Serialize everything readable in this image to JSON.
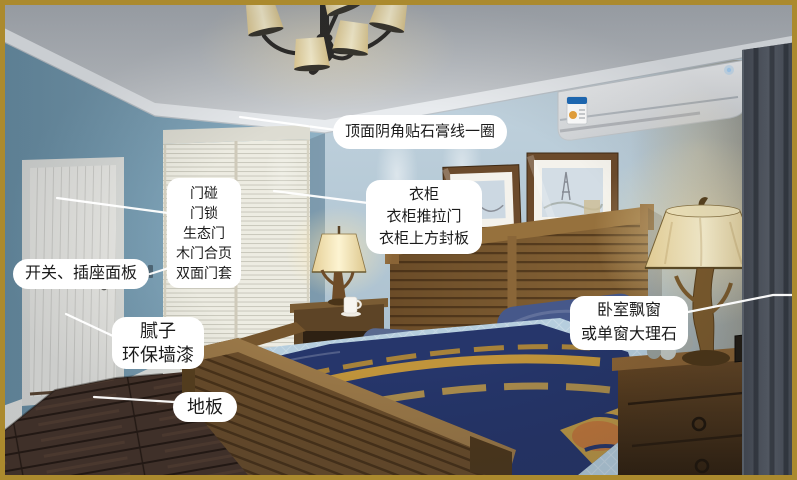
{
  "annotations": {
    "ceiling_molding": {
      "lines": [
        "顶面阴角贴石膏线一圈"
      ]
    },
    "door": {
      "lines": [
        "门碰",
        "门锁",
        "生态门",
        "木门合页",
        "双面门套"
      ]
    },
    "switch_socket": {
      "lines": [
        "开关、插座面板"
      ]
    },
    "wall_finish": {
      "lines": [
        "腻子",
        "环保墙漆"
      ]
    },
    "floor": {
      "lines": [
        "地板"
      ]
    },
    "wardrobe": {
      "lines": [
        "衣柜",
        "衣柜推拉门",
        "衣柜上方封板"
      ]
    },
    "bay_window": {
      "lines": [
        "卧室飘窗",
        "或单窗大理石"
      ]
    }
  },
  "colors": {
    "frame_border": "#ab8a2e",
    "label_background": "#ffffff",
    "label_text": "#1b1b1b",
    "leader_line": "#ffffff",
    "left_wall_blue": "#7fa3b8",
    "back_wall_blue": "#b4c8d4",
    "floor_wood": "#45322a",
    "bed_spread": "#b6cede",
    "blanket_navy": "#26366b",
    "blanket_gold": "#d19f36"
  },
  "scene_objects": [
    "chandelier",
    "air-conditioner",
    "entry-door",
    "wardrobe-sliding-doors",
    "framed-pictures",
    "bed",
    "headboard",
    "pillows",
    "throw-blanket",
    "nightstand",
    "table-lamp",
    "dresser",
    "curtain",
    "wood-floor",
    "wall-switch"
  ]
}
